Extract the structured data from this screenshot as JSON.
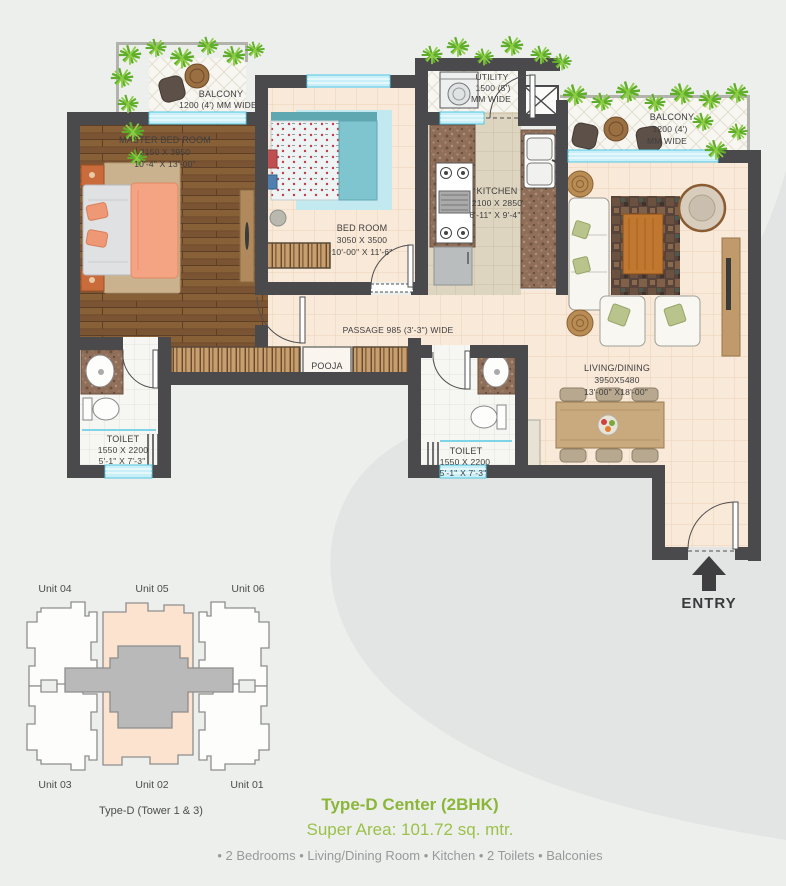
{
  "plan": {
    "balcony_left": {
      "line1": "BALCONY",
      "line2": "1200 (4') MM WIDE"
    },
    "balcony_right": {
      "line1": "BALCONY",
      "line2": "1200 (4')",
      "line3": "MM WIDE"
    },
    "master_bedroom": {
      "name": "MASTER BED ROOM",
      "dim_mm": "3150 X 3950",
      "dim_ft": "10'-4\" X 13'-00\""
    },
    "bedroom": {
      "name": "BED ROOM",
      "dim_mm": "3050 X 3500",
      "dim_ft": "10'-00\" X 11'-6\""
    },
    "utility": {
      "line1": "UTILITY",
      "line2": "1500 (5')",
      "line3": "MM WIDE"
    },
    "kitchen": {
      "name": "KITCHEN",
      "dim_mm": "2100 X 2850",
      "dim_ft": "6'-11\" X 9'-4\""
    },
    "living_dining": {
      "name": "LIVING/DINING",
      "dim_mm": "3950X5480",
      "dim_ft": "13'-00\" X18'-00\""
    },
    "toilet_left": {
      "name": "TOILET",
      "dim_mm": "1550 X 2200",
      "dim_ft": "5'-1\" X 7'-3\""
    },
    "toilet_right": {
      "name": "TOILET",
      "dim_mm": "1550 X 2200",
      "dim_ft": "5'-1\" X 7'-3\""
    },
    "passage": {
      "label": "PASSAGE 985 (3'-3\") WIDE"
    },
    "pooja": {
      "label": "POOJA"
    },
    "entry": {
      "label": "ENTRY"
    }
  },
  "tower_diagram": {
    "units_top": [
      "Unit 04",
      "Unit 05",
      "Unit 06"
    ],
    "units_bottom": [
      "Unit 03",
      "Unit 02",
      "Unit 01"
    ],
    "caption": "Type-D (Tower 1 & 3)"
  },
  "footer": {
    "title": "Type-D Center (2BHK)",
    "super_area": "Super Area: 101.72 sq. mtr.",
    "features": "• 2 Bedrooms • Living/Dining Room • Kitchen • 2 Toilets • Balconies"
  },
  "colors": {
    "accent_green": "#8cb63a",
    "wall": "#4a4a4c",
    "highlight_peach": "#fbe3cf",
    "window_cyan": "#c9f0f8"
  }
}
